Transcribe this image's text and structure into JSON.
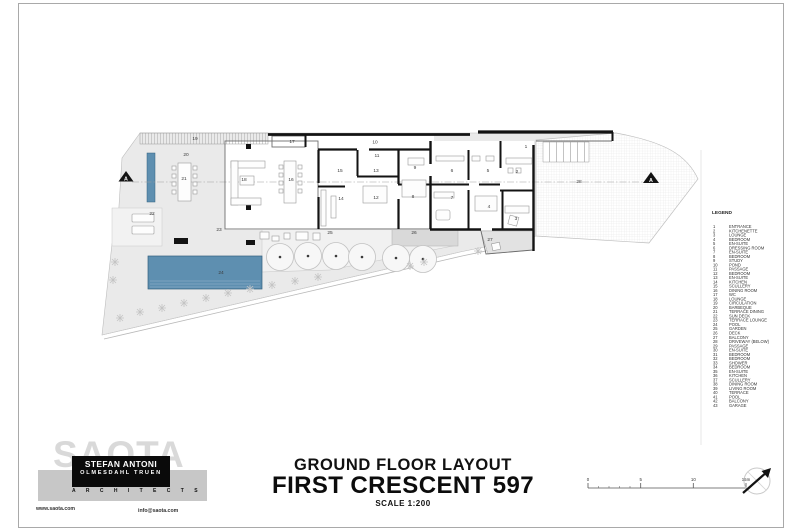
{
  "sheet": {
    "title_block": {
      "line1": "GROUND FLOOR LAYOUT",
      "line2": "FIRST CRESCENT 597",
      "line3": "SCALE 1:200"
    },
    "logo": {
      "watermark": "SAOTA",
      "firm_line1": "STEFAN ANTONI",
      "firm_line2": "OLMESDAHL TRUEN",
      "firm_line3": "A R C H I T E C T S",
      "website": "www.saota.com",
      "email": "info@saota.com"
    },
    "legend": {
      "title": "LEGEND",
      "items": [
        {
          "num": 1,
          "label": "ENTRANCE"
        },
        {
          "num": 2,
          "label": "KITCHENETTE"
        },
        {
          "num": 3,
          "label": "LOUNGE"
        },
        {
          "num": 4,
          "label": "BEDROOM"
        },
        {
          "num": 5,
          "label": "EN-SUITE"
        },
        {
          "num": 6,
          "label": "DRESSING ROOM"
        },
        {
          "num": 7,
          "label": "EN-SUITE"
        },
        {
          "num": 8,
          "label": "BEDROOM"
        },
        {
          "num": 9,
          "label": "STUDY"
        },
        {
          "num": 10,
          "label": "POND"
        },
        {
          "num": 11,
          "label": "PASSAGE"
        },
        {
          "num": 12,
          "label": "BEDROOM"
        },
        {
          "num": 13,
          "label": "EN-SUITE"
        },
        {
          "num": 14,
          "label": "KITCHEN"
        },
        {
          "num": 15,
          "label": "SCULLERY"
        },
        {
          "num": 16,
          "label": "DINING ROOM"
        },
        {
          "num": 17,
          "label": "WC"
        },
        {
          "num": 18,
          "label": "LOUNGE"
        },
        {
          "num": 19,
          "label": "CIRCULATION"
        },
        {
          "num": 20,
          "label": "BARBEQUE"
        },
        {
          "num": 21,
          "label": "TERRACE DINING"
        },
        {
          "num": 22,
          "label": "SUN DECK"
        },
        {
          "num": 23,
          "label": "TERRACE LOUNGE"
        },
        {
          "num": 24,
          "label": "POOL"
        },
        {
          "num": 25,
          "label": "GARDEN"
        },
        {
          "num": 26,
          "label": "DECK"
        },
        {
          "num": 27,
          "label": "BALCONY"
        },
        {
          "num": 28,
          "label": "DRIVEWAY (BELOW)"
        },
        {
          "num": 29,
          "label": "PASSAGE"
        },
        {
          "num": 30,
          "label": "EN-SUITE"
        },
        {
          "num": 31,
          "label": "BEDROOM"
        },
        {
          "num": 32,
          "label": "BEDROOM"
        },
        {
          "num": 33,
          "label": "SHOWER"
        },
        {
          "num": 34,
          "label": "BEDROOM"
        },
        {
          "num": 35,
          "label": "EN-SUITE"
        },
        {
          "num": 36,
          "label": "KITCHEN"
        },
        {
          "num": 37,
          "label": "SCULLERY"
        },
        {
          "num": 38,
          "label": "DINING ROOM"
        },
        {
          "num": 39,
          "label": "LIVING ROOM"
        },
        {
          "num": 40,
          "label": "TERRACE"
        },
        {
          "num": 41,
          "label": "POOL"
        },
        {
          "num": 42,
          "label": "BALCONY"
        },
        {
          "num": 43,
          "label": "GARAGE"
        }
      ]
    },
    "plan": {
      "section_marker": "A",
      "colors": {
        "water": "#5e8fb0",
        "wall": "#131313",
        "terrace": "#eaeaea",
        "deck": "#d9d9d9"
      },
      "labels": [
        {
          "n": "1",
          "x": 526,
          "y": 148
        },
        {
          "n": "2",
          "x": 517,
          "y": 173
        },
        {
          "n": "3",
          "x": 516,
          "y": 220
        },
        {
          "n": "4",
          "x": 489,
          "y": 208
        },
        {
          "n": "5",
          "x": 488,
          "y": 172
        },
        {
          "n": "6",
          "x": 452,
          "y": 172
        },
        {
          "n": "7",
          "x": 452,
          "y": 199
        },
        {
          "n": "8",
          "x": 413,
          "y": 198
        },
        {
          "n": "9",
          "x": 415,
          "y": 169
        },
        {
          "n": "10",
          "x": 375,
          "y": 143.5
        },
        {
          "n": "11",
          "x": 377,
          "y": 157
        },
        {
          "n": "12",
          "x": 376,
          "y": 199
        },
        {
          "n": "13",
          "x": 376,
          "y": 172
        },
        {
          "n": "14",
          "x": 341,
          "y": 200
        },
        {
          "n": "15",
          "x": 340,
          "y": 172
        },
        {
          "n": "16",
          "x": 291,
          "y": 181
        },
        {
          "n": "17",
          "x": 292,
          "y": 143
        },
        {
          "n": "18",
          "x": 244,
          "y": 181
        },
        {
          "n": "19",
          "x": 195,
          "y": 140
        },
        {
          "n": "20",
          "x": 186,
          "y": 156
        },
        {
          "n": "21",
          "x": 184,
          "y": 180
        },
        {
          "n": "22",
          "x": 152,
          "y": 215
        },
        {
          "n": "23",
          "x": 219,
          "y": 231
        },
        {
          "n": "24",
          "x": 221,
          "y": 274
        },
        {
          "n": "25",
          "x": 330,
          "y": 234
        },
        {
          "n": "26",
          "x": 414,
          "y": 234
        },
        {
          "n": "27",
          "x": 490,
          "y": 241
        },
        {
          "n": "28",
          "x": 579,
          "y": 183
        }
      ]
    },
    "scale_bar": {
      "ticks": [
        "0",
        "5",
        "10",
        "15m"
      ]
    }
  }
}
